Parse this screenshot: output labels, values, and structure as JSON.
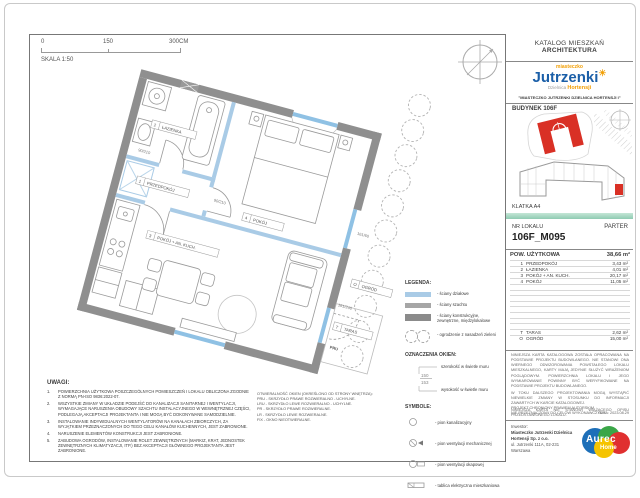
{
  "scale": {
    "t0": "0",
    "t1": "150",
    "t2": "300CM",
    "label": "SKALA 1:50"
  },
  "header": {
    "line1": "KATALOG MIESZKAŃ",
    "line2": "ARCHITEKTURA"
  },
  "logo": {
    "top": "miasteczko",
    "main": "Jutrzenki",
    "sub1": "Dzielnica",
    "sub2": "Hortensji",
    "quote": "\"MIASTECZKO JUTRZENKI DZIELNICA HORTENSJI I\""
  },
  "building": {
    "label": "BUDYNEK 106F"
  },
  "klatka": {
    "label": "KLATKA A4"
  },
  "unit": {
    "nr_label": "NR LOKALU",
    "floor": "PARTER",
    "code": "106F_M095"
  },
  "table": {
    "header_label": "POW. UŻYTKOWA",
    "header_value": "38,66 m²",
    "rooms": [
      {
        "no": "1",
        "name": "PRZEDPOKÓJ",
        "area": "3,43 m²"
      },
      {
        "no": "2",
        "name": "ŁAZIENKA",
        "area": "4,01 m²"
      },
      {
        "no": "3",
        "name": "POKÓJ + AN. KUCH.",
        "area": "20,17 m²"
      },
      {
        "no": "4",
        "name": "POKÓJ",
        "area": "11,05 m²"
      }
    ],
    "extras": [
      {
        "no": "T",
        "name": "TARAS",
        "area": "2,62 m²"
      },
      {
        "no": "O",
        "name": "OGRÓD",
        "area": "15,00 m²"
      }
    ]
  },
  "legal": {
    "p1": "NINIEJSZA KARTA KATALOGOWA ZOSTAŁA OPRACOWANA NA PODSTAWIE PROJEKTU BUDOWLANEGO. NIE STANOWI ONA WIERNEGO ODWZOROWANIA POWSTAŁEGO LOKALU MIESZKALNEGO, KARTY MAJĄ JEDYNIE SŁUŻYĆ WRAŻENIOM POGLĄDOWYM. POWIERZCHNIA LOKALU I JEGO WYMIAROWANIE POWINNY BYĆ WERYFIKOWANE NA PODSTAWIE PROJEKTU BUDOWLANEGO.",
    "p2": "W TOKU DALSZEGO PROJEKTOWANIA MOGĄ WYSTĄPIĆ NIEWIELKIE ZMIANY W STOSUNKU DO INFORMACJI ZAWARTYCH W KARCIE KATALOGOWEJ.",
    "p3": "NINIEJSZA KARTA NIE STANOWI WIĄŻĄCEGO OPISU PRZEDSTAWIONEGO LOKALU.",
    "c1": "PROJEKT CHRONIONY PRAWEM AUTORSKIM",
    "c2": "NIE PRZEZNACZONY DO CELÓW WYKONAWCZYCH.",
    "date": "DATA: 2023.08.29"
  },
  "invest": {
    "label": "Inwestor:",
    "name": "Miasteczko Jutrzenki Dzielnica Hortensji Sp. z o.o.",
    "addr": "ul. Jutrzenki 111A, 02-231 Warszawa"
  },
  "aurec": {
    "name": "Aurec",
    "sub": "Home"
  },
  "legend": {
    "title": "LEGENDA:",
    "items": [
      {
        "label": "- ściany działowe"
      },
      {
        "label": "- ściany szachtu"
      },
      {
        "label": "- ściany konstrukcyjne, zewnętrzne, międzylokalowe"
      },
      {
        "label": "- ogrodzenie z nasadzeń zieleni"
      }
    ]
  },
  "okna": {
    "title": "OZNACZENIA OKIEN:",
    "w": "150",
    "h": "153",
    "width_label": "szerokość w świetle muru",
    "height_label": "wysokość w świetle muru"
  },
  "symbole": {
    "title": "SYMBOLE:",
    "items": [
      {
        "label": "- pion kanalizacyjny"
      },
      {
        "label": "- pion wentylacji mechanicznej"
      },
      {
        "label": "- pion wentylacji okapowej"
      },
      {
        "label": "- tablica elektryczna mieszkaniowa"
      }
    ]
  },
  "uwagi": {
    "title": "UWAGI:",
    "items": [
      {
        "no": "1.",
        "text": "POWIERZCHNIA UŻYTKOWA POSZCZEGÓLNYCH POMIESZCZEŃ I LOKALU OBLICZONA ZGODNIE Z NORMĄ PN-ISO 9836:2022-07."
      },
      {
        "no": "2.",
        "text": "WSZYSTKIE ZMIANY W UKŁADZIE PODEJŚĆ DO KANALIZACJI SANITARNEJ I WENTYLACJI, WYMAGAJĄCE NARUSZENIA OBUDOWY SZACHTU INSTALACYJNEGO W WEWNĘTRZNEJ CZĘŚCI, PODLEGAJĄ AKCEPTACJI PROJEKTANTA I NIE MOGĄ BYĆ DOKONYWANE SAMODZIELNIE."
      },
      {
        "no": "3.",
        "text": "INSTALOWANIE INDYWIDUALNYCH WENTYLATORÓW NA KANAŁACH ZBIORCZYCH, ZA WYJĄTKIEM PRZEZNACZONYCH DO TEGO CELU KANAŁÓW KUCHENNYCH, JEST ZABRONIONE."
      },
      {
        "no": "4.",
        "text": "NARUSZENIE ELEMENTÓW KONSTRUKCJI JEST ZABRONIONE."
      },
      {
        "no": "5.",
        "text": "ZABUDOWA OGRODÓW, INSTALOWANIE ROLET ZEWNĘTRZNYCH (MARKIZ, KRAT, JEDNOSTEK ZEWNĘTRZNYCH KLIMATYZACJI, ITP.) BEZ AKCEPTACJI GŁÓWNEGO PROJEKTANTA JEST ZABRONIONE."
      }
    ]
  },
  "otwier": {
    "title": "OTWIERALNOŚĆ OKIEN (OKREŚLONO OD STRONY WNĘTRZA):",
    "items": [
      {
        "text": "PRU - SKRZYDŁO PRAWE ROZWIERALNO - UCHYLNE."
      },
      {
        "text": "LRU - SKRZYDŁO LEWE ROZWIERALNO - UCHYLNE."
      },
      {
        "text": "PR - SKRZYDŁO PRAWE ROZWIERALNE."
      },
      {
        "text": "LR - SKRZYDŁO LEWE ROZWIERALNE."
      },
      {
        "text": "FIX - OKNO NIEOTWIERALNE."
      }
    ]
  },
  "plan": {
    "rooms": [
      {
        "no": "2",
        "name": "ŁAZIENKA"
      },
      {
        "no": "1",
        "name": "PRZEDPOKÓJ"
      },
      {
        "no": "4",
        "name": "POKÓJ"
      },
      {
        "no": "3",
        "name": "POKÓJ + AN. KUCH."
      },
      {
        "no": "T",
        "name": "TARAS"
      },
      {
        "no": "O",
        "name": "OGRÓD"
      }
    ],
    "dims": {
      "d1": "90/210",
      "d2": "90/210",
      "d3": "161/60",
      "d4": "161/240"
    },
    "door_code": "PRU"
  },
  "colors": {
    "wall": "#8f8f8f",
    "partition": "#a9cbe6",
    "window": "#8fc1e4",
    "teal": "#a8d8c4",
    "red": "#d93025",
    "brand_blue": "#1b5fa8",
    "brand_orange": "#f29f05",
    "aurec_blue": "#1d6fb8",
    "aurec_green": "#3aa648",
    "aurec_red": "#e03030",
    "aurec_yellow": "#f5c400"
  }
}
